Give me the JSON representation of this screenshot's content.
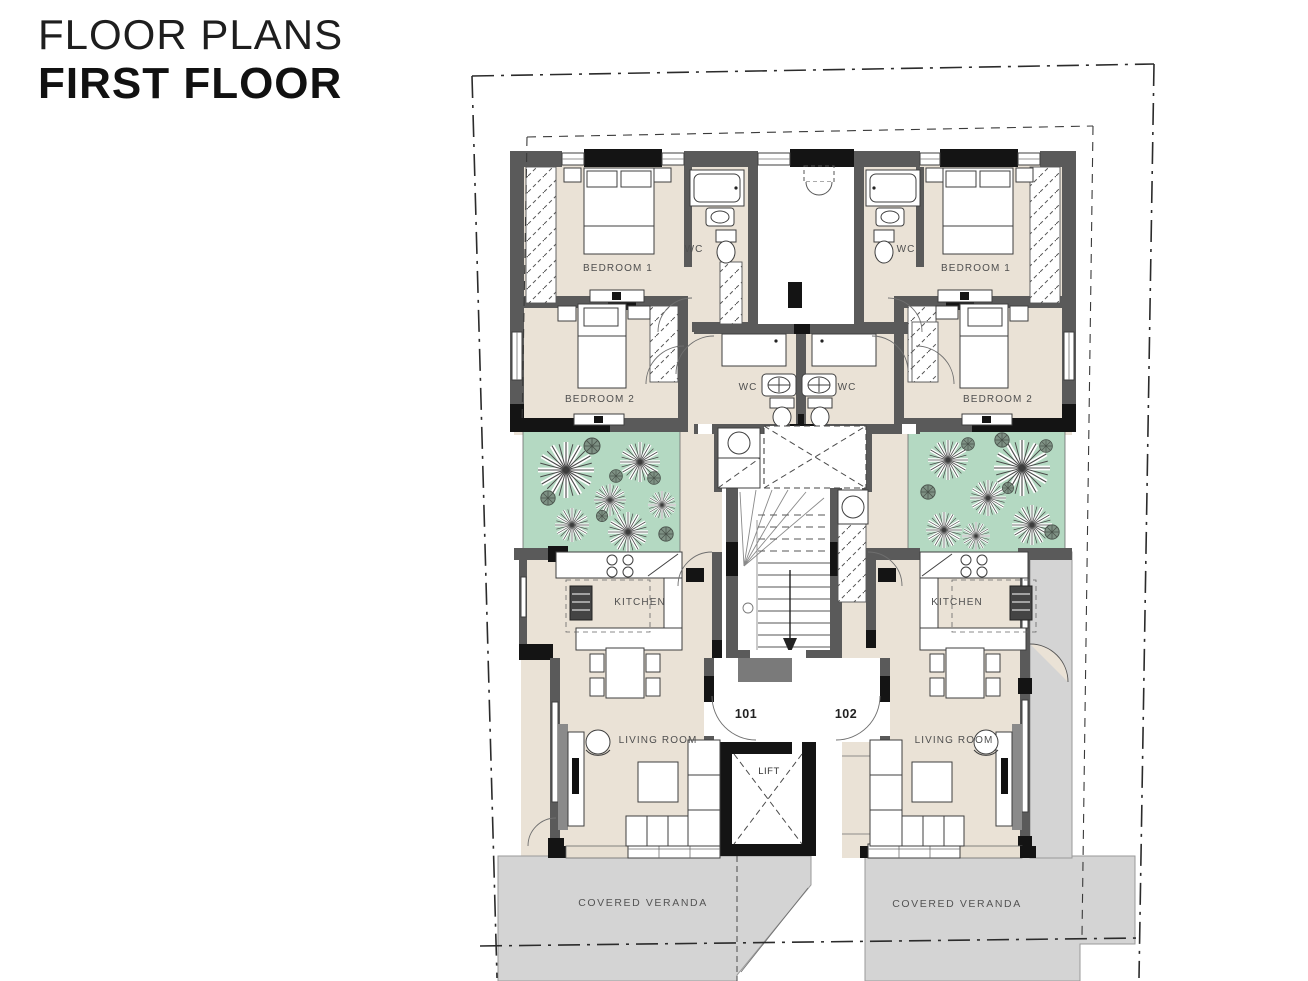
{
  "page": {
    "title_line1": "FLOOR PLANS",
    "title_line2": "FIRST FLOOR"
  },
  "plan": {
    "room_labels": {
      "bedroom1": "BEDROOM 1",
      "bedroom2": "BEDROOM 2",
      "wc": "WC",
      "kitchen": "KITCHEN",
      "living_room": "LIVING ROOM",
      "lift": "LIFT",
      "covered_veranda": "COVERED VERANDA"
    },
    "units": [
      {
        "label": "101"
      },
      {
        "label": "102"
      }
    ],
    "colors": {
      "floor": "#EAE2D6",
      "wall": "#5A5A5A",
      "wall_accent": "#141414",
      "garden": "#B4D9C2",
      "veranda": "#D4D4D4",
      "label_text": "#4F4F4F"
    }
  }
}
